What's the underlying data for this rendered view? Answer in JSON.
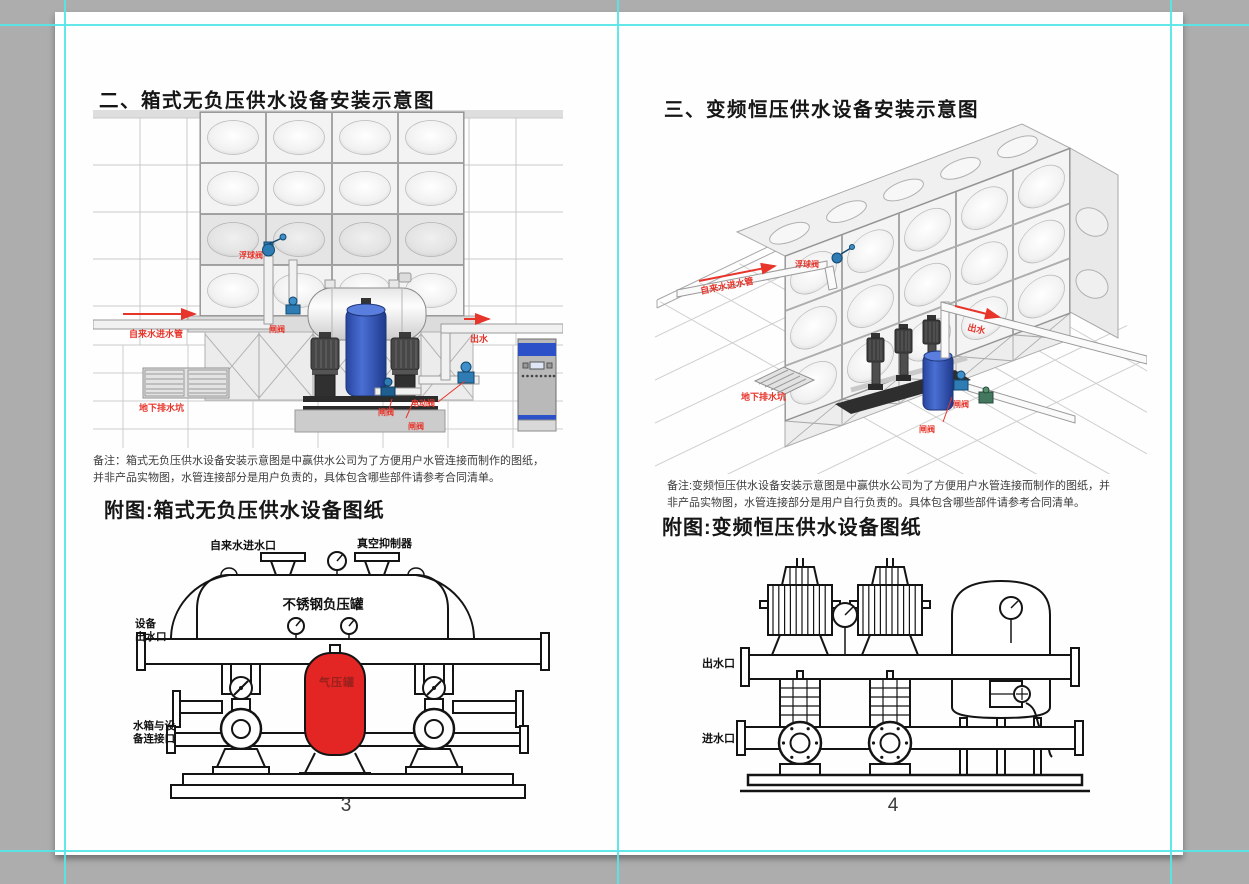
{
  "colors": {
    "accent_red": "#e8352b",
    "guide_cyan": "#55e6e6",
    "workspace_gray": "#adadad",
    "page_white": "#fefefe"
  },
  "left_page": {
    "title": "二、箱式无负压供水设备安装示意图",
    "note": [
      "备注：箱式无负压供水设备安装示意图是中赢供水公司为了方便用户水管连接而制作的图纸，",
      "并非产品实物图，水管连接部分是用户负责的，具体包含哪些部件请参考合同清单。"
    ],
    "subtitle": "附图:箱式无负压供水设备图纸",
    "page_number": "3",
    "diagram": {
      "inlet_pipe_label": "自来水进水管",
      "float_valve_label": "浮球阀",
      "gate_valve_top_label": "闸阀",
      "outlet_label": "出水",
      "drain_pit_label": "地下排水坑",
      "gate_valve_label": "闸阀",
      "electric_valve_label": "电动阀",
      "gate_valve2_label": "闸阀"
    },
    "subfigure": {
      "tap_inlet_label": "自来水进水口",
      "vacuum_suppressor_label": "真空抑制器",
      "tank_label": "不锈钢负压罐",
      "outlet_port_line1": "设备",
      "outlet_port_line2": "出水口",
      "air_tank_label": "气压罐",
      "tank_connect_line1": "水箱与设",
      "tank_connect_line2": "备连接口"
    }
  },
  "right_page": {
    "title": "三、变频恒压供水设备安装示意图",
    "note": [
      "备注:变频恒压供水设备安装示意图是中赢供水公司为了方便用户水管连接而制作的图纸，并",
      "非产品实物图，水管连接部分是用户自行负责的。具体包含哪些部件请参考合同清单。"
    ],
    "subtitle": "附图:变频恒压供水设备图纸",
    "page_number": "4",
    "diagram": {
      "inlet_pipe_label": "自来水进水管",
      "float_valve_label": "浮球阀",
      "outlet_label": "出水",
      "drain_pit_label": "地下排水坑",
      "gate_valve_label": "闸阀",
      "gate_valve2_label": "闸阀"
    },
    "subfigure": {
      "outlet_port_label": "出水口",
      "inlet_port_label": "进水口"
    }
  }
}
